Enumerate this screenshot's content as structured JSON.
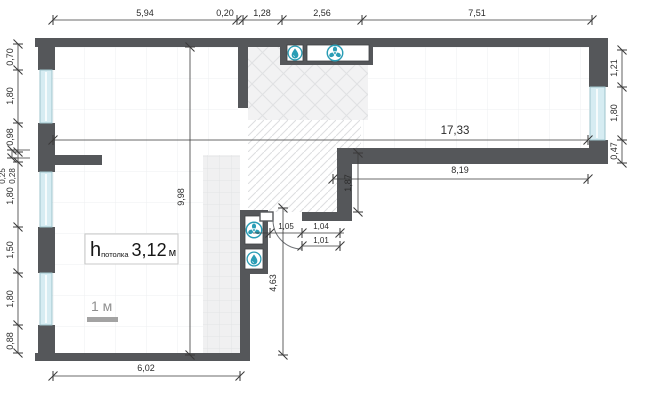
{
  "drawing": {
    "type": "apartment-floor-plan",
    "units": "meters-comma-decimal"
  },
  "dims": {
    "top": [
      "5,94",
      "0,20",
      "1,28",
      "2,56",
      "7,51"
    ],
    "left": [
      "0,70",
      "1,80",
      "0,98",
      "0,25",
      "0,28",
      "1,80",
      "1,50",
      "1,80",
      "0,88"
    ],
    "right": [
      "1,21",
      "1,80",
      "0,47"
    ],
    "inner": {
      "total_width": "17,33",
      "right_wing_width": "8,19",
      "left_room_height": "9,98",
      "step_height": "1,87",
      "door_a": "1,05",
      "door_b": "1,04",
      "door_c": "1,01",
      "lower_height": "4,63",
      "bottom_width": "6,02"
    }
  },
  "ceiling": {
    "symbol": "h",
    "subscript": "потолка",
    "value": "3,12",
    "unit": "м"
  },
  "scale": {
    "label": "1 м"
  },
  "icons": {
    "top_shaft": [
      "water-riser",
      "ventilation-fan"
    ],
    "middle_shaft": [
      "ventilation-fan",
      "water-riser"
    ]
  },
  "colors": {
    "wall": "#55575a",
    "window_glass": "#d6ecf2",
    "icon_teal": "#2a9db5",
    "dim_line": "#3a3a3a",
    "hatch": "#e0e1e3",
    "tile_bg": "#f0f0f1"
  }
}
